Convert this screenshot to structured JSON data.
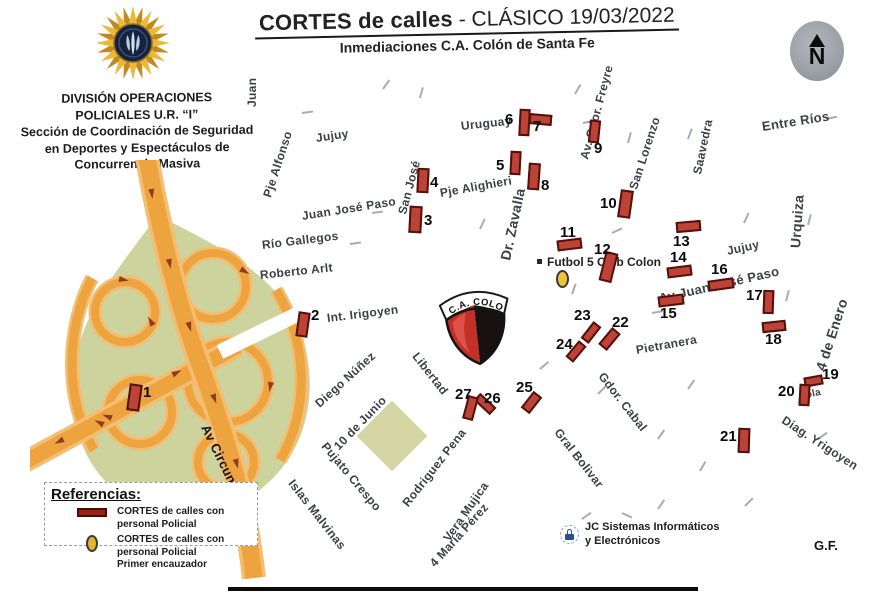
{
  "header": {
    "title_bold": "CORTES de calles",
    "title_rest": " - CLÁSICO 19/03/2022",
    "subtitle": "Inmediaciones C.A. Colón de Santa Fe"
  },
  "division": {
    "lines": [
      "DIVISIÓN OPERACIONES",
      "POLICIALES U.R. “I”",
      "Sección de Coordinación de Seguridad",
      "en Deportes y Espectáculos de",
      "Concurrencia Masiva"
    ]
  },
  "compass": {
    "letter": "N"
  },
  "colors": {
    "cut_fill": "#bc4338",
    "cut_border": "#54100a",
    "road_orange": "#eda43f",
    "road_casing": "#f3bd72",
    "green_area": "#ccd39d",
    "encauzador_yellow": "#eec43a",
    "crest_red": "#c23028",
    "crest_black": "#181011"
  },
  "map": {
    "crest_label": "C.A. COLON",
    "futbol5_label": "Futbol 5 Club Colon",
    "circunvalacion_label": "Av Circunvalación",
    "streets": [
      {
        "t": "Juan",
        "x": 252,
        "y": 100,
        "r": -90
      },
      {
        "t": "Jujuy",
        "x": 316,
        "y": 131,
        "r": -8
      },
      {
        "t": "Pje Alfonso",
        "x": 267,
        "y": 190,
        "r": -72
      },
      {
        "t": "San José",
        "x": 402,
        "y": 207,
        "r": -75
      },
      {
        "t": "Pje Alighieri",
        "x": 440,
        "y": 186,
        "r": -10
      },
      {
        "t": "Juan José Paso",
        "x": 302,
        "y": 209,
        "r": -9
      },
      {
        "t": "Río Gallegos",
        "x": 262,
        "y": 238,
        "r": -7
      },
      {
        "t": "Roberto Arlt",
        "x": 260,
        "y": 268,
        "r": -6
      },
      {
        "t": "Int. Irigoyen",
        "x": 327,
        "y": 311,
        "r": -7
      },
      {
        "t": "Uruguay",
        "x": 461,
        "y": 119,
        "r": -6
      },
      {
        "t": "Dr. Zavalla",
        "x": 505,
        "y": 252,
        "r": -78,
        "s": 14,
        "b": 1
      },
      {
        "t": "Av. Gdor. Freyre",
        "x": 584,
        "y": 152,
        "r": -75
      },
      {
        "t": "San Lorenzo",
        "x": 633,
        "y": 182,
        "r": -72
      },
      {
        "t": "Saavedra",
        "x": 697,
        "y": 167,
        "r": -78
      },
      {
        "t": "Entre Ríos",
        "x": 762,
        "y": 119,
        "r": -9,
        "s": 13
      },
      {
        "t": "Urquiza",
        "x": 795,
        "y": 240,
        "r": -86,
        "s": 14,
        "b": 1
      },
      {
        "t": "Jujuy",
        "x": 727,
        "y": 244,
        "r": -12
      },
      {
        "t": "Av Juan José Paso",
        "x": 659,
        "y": 291,
        "r": -13,
        "s": 13,
        "b": 1
      },
      {
        "t": "4 de Enero",
        "x": 820,
        "y": 362,
        "r": -72,
        "s": 14,
        "b": 1
      },
      {
        "t": "Pietranera",
        "x": 636,
        "y": 343,
        "r": -10
      },
      {
        "t": "Gdor. Cabal",
        "x": 601,
        "y": 367,
        "r": 52
      },
      {
        "t": "Gral Bolivar",
        "x": 557,
        "y": 423,
        "r": 52
      },
      {
        "t": "Diag. Yrigoyen",
        "x": 783,
        "y": 412,
        "r": 33
      },
      {
        "t": "Libertad",
        "x": 415,
        "y": 347,
        "r": 52
      },
      {
        "t": "Diego Núñez",
        "x": 317,
        "y": 398,
        "r": -42
      },
      {
        "t": "10 de Junio",
        "x": 336,
        "y": 441,
        "r": -46
      },
      {
        "t": "Pujato Crespo",
        "x": 324,
        "y": 437,
        "r": 50
      },
      {
        "t": "Islas Malvinas",
        "x": 291,
        "y": 474,
        "r": 52
      },
      {
        "t": "Rodriguez Pena",
        "x": 405,
        "y": 498,
        "r": -52
      },
      {
        "t": "Vera Mujica",
        "x": 446,
        "y": 533,
        "r": -55
      },
      {
        "t": "4 María Pérez",
        "x": 432,
        "y": 558,
        "r": -48
      },
      {
        "t": "ola",
        "x": 806,
        "y": 390,
        "r": -12,
        "s": 10
      }
    ],
    "cuts": [
      {
        "n": "1",
        "x": 128,
        "y": 384,
        "w": 13,
        "h": 27,
        "r": 8,
        "nx": 143,
        "ny": 384
      },
      {
        "n": "2",
        "x": 297,
        "y": 312,
        "w": 12,
        "h": 25,
        "r": 8,
        "nx": 311,
        "ny": 307
      },
      {
        "n": "3",
        "x": 409,
        "y": 206,
        "w": 13,
        "h": 27,
        "r": 3,
        "nx": 424,
        "ny": 212
      },
      {
        "n": "4",
        "x": 417,
        "y": 168,
        "w": 12,
        "h": 25,
        "r": 3,
        "nx": 430,
        "ny": 174
      },
      {
        "n": "5",
        "x": 510,
        "y": 151,
        "w": 11,
        "h": 24,
        "r": 3,
        "nx": 496,
        "ny": 157
      },
      {
        "n": "6",
        "x": 519,
        "y": 109,
        "w": 11,
        "h": 27,
        "r": 3,
        "nx": 505,
        "ny": 111
      },
      {
        "n": "7",
        "x": 529,
        "y": 114,
        "w": 23,
        "h": 11,
        "r": 5,
        "nx": 533,
        "ny": 118
      },
      {
        "n": "8",
        "x": 528,
        "y": 163,
        "w": 12,
        "h": 27,
        "r": 4,
        "nx": 541,
        "ny": 177
      },
      {
        "n": "9",
        "x": 589,
        "y": 120,
        "w": 11,
        "h": 23,
        "r": 6,
        "nx": 594,
        "ny": 140
      },
      {
        "n": "10",
        "x": 619,
        "y": 190,
        "w": 13,
        "h": 28,
        "r": 8,
        "nx": 600,
        "ny": 195
      },
      {
        "n": "11",
        "x": 557,
        "y": 239,
        "w": 25,
        "h": 11,
        "r": -7,
        "nx": 560,
        "ny": 224
      },
      {
        "n": "12",
        "x": 602,
        "y": 252,
        "w": 13,
        "h": 30,
        "r": 14,
        "nx": 594,
        "ny": 241
      },
      {
        "n": "13",
        "x": 676,
        "y": 221,
        "w": 25,
        "h": 11,
        "r": -5,
        "nx": 673,
        "ny": 233
      },
      {
        "n": "14",
        "x": 667,
        "y": 266,
        "w": 25,
        "h": 11,
        "r": -7,
        "nx": 670,
        "ny": 249
      },
      {
        "n": "15",
        "x": 658,
        "y": 295,
        "w": 26,
        "h": 11,
        "r": -7,
        "nx": 660,
        "ny": 305
      },
      {
        "n": "16",
        "x": 708,
        "y": 279,
        "w": 26,
        "h": 11,
        "r": -8,
        "nx": 711,
        "ny": 261
      },
      {
        "n": "17",
        "x": 763,
        "y": 290,
        "w": 11,
        "h": 24,
        "r": 2,
        "nx": 746,
        "ny": 287
      },
      {
        "n": "18",
        "x": 762,
        "y": 321,
        "w": 24,
        "h": 11,
        "r": -6,
        "nx": 765,
        "ny": 331
      },
      {
        "n": "19",
        "x": 804,
        "y": 376,
        "w": 19,
        "h": 10,
        "r": -10,
        "nx": 822,
        "ny": 366
      },
      {
        "n": "20",
        "x": 799,
        "y": 384,
        "w": 11,
        "h": 22,
        "r": 3,
        "nx": 778,
        "ny": 383
      },
      {
        "n": "21",
        "x": 738,
        "y": 428,
        "w": 12,
        "h": 25,
        "r": 2,
        "nx": 720,
        "ny": 428
      },
      {
        "n": "22",
        "x": 604,
        "y": 328,
        "w": 11,
        "h": 22,
        "r": 40,
        "nx": 612,
        "ny": 314
      },
      {
        "n": "23",
        "x": 586,
        "y": 322,
        "w": 10,
        "h": 21,
        "r": 38,
        "nx": 574,
        "ny": 307
      },
      {
        "n": "24",
        "x": 571,
        "y": 341,
        "w": 10,
        "h": 21,
        "r": 40,
        "nx": 556,
        "ny": 336
      },
      {
        "n": "25",
        "x": 526,
        "y": 392,
        "w": 11,
        "h": 21,
        "r": 38,
        "nx": 516,
        "ny": 379
      },
      {
        "n": "26",
        "x": 474,
        "y": 399,
        "w": 22,
        "h": 10,
        "r": 43,
        "nx": 484,
        "ny": 390
      },
      {
        "n": "27",
        "x": 465,
        "y": 396,
        "w": 11,
        "h": 24,
        "r": 15,
        "nx": 455,
        "ny": 386
      }
    ],
    "direction_ticks": [
      {
        "x": 383,
        "y": 88,
        "r": -55
      },
      {
        "x": 420,
        "y": 97,
        "r": -75
      },
      {
        "x": 575,
        "y": 93,
        "r": -60
      },
      {
        "x": 302,
        "y": 112,
        "r": -8
      },
      {
        "x": 583,
        "y": 122,
        "r": -12
      },
      {
        "x": 628,
        "y": 142,
        "r": -75
      },
      {
        "x": 688,
        "y": 138,
        "r": -70
      },
      {
        "x": 826,
        "y": 118,
        "r": -12
      },
      {
        "x": 372,
        "y": 212,
        "r": -8
      },
      {
        "x": 480,
        "y": 228,
        "r": -65
      },
      {
        "x": 612,
        "y": 232,
        "r": -25
      },
      {
        "x": 744,
        "y": 222,
        "r": -65
      },
      {
        "x": 808,
        "y": 224,
        "r": -75
      },
      {
        "x": 652,
        "y": 312,
        "r": -10
      },
      {
        "x": 786,
        "y": 300,
        "r": -75
      },
      {
        "x": 540,
        "y": 368,
        "r": -40
      },
      {
        "x": 598,
        "y": 393,
        "r": -45
      },
      {
        "x": 688,
        "y": 388,
        "r": -55
      },
      {
        "x": 658,
        "y": 438,
        "r": -55
      },
      {
        "x": 818,
        "y": 438,
        "r": -35
      },
      {
        "x": 582,
        "y": 518,
        "r": -35
      },
      {
        "x": 622,
        "y": 512,
        "r": 25
      },
      {
        "x": 658,
        "y": 508,
        "r": -55
      },
      {
        "x": 350,
        "y": 243,
        "r": -8
      },
      {
        "x": 572,
        "y": 293,
        "r": -70
      },
      {
        "x": 700,
        "y": 470,
        "r": -60
      },
      {
        "x": 745,
        "y": 505,
        "r": -45
      }
    ]
  },
  "legend": {
    "title": "Referencias:",
    "items": [
      {
        "text": "CORTES de calles con personal Policial"
      },
      {
        "text": "CORTES de calles con personal Policial",
        "text2": "Primer encauzador"
      }
    ]
  },
  "footer": {
    "credit_line1": "JC Sistemas Informáticos",
    "credit_line2": "y Electrónicos",
    "initials": "G.F."
  }
}
